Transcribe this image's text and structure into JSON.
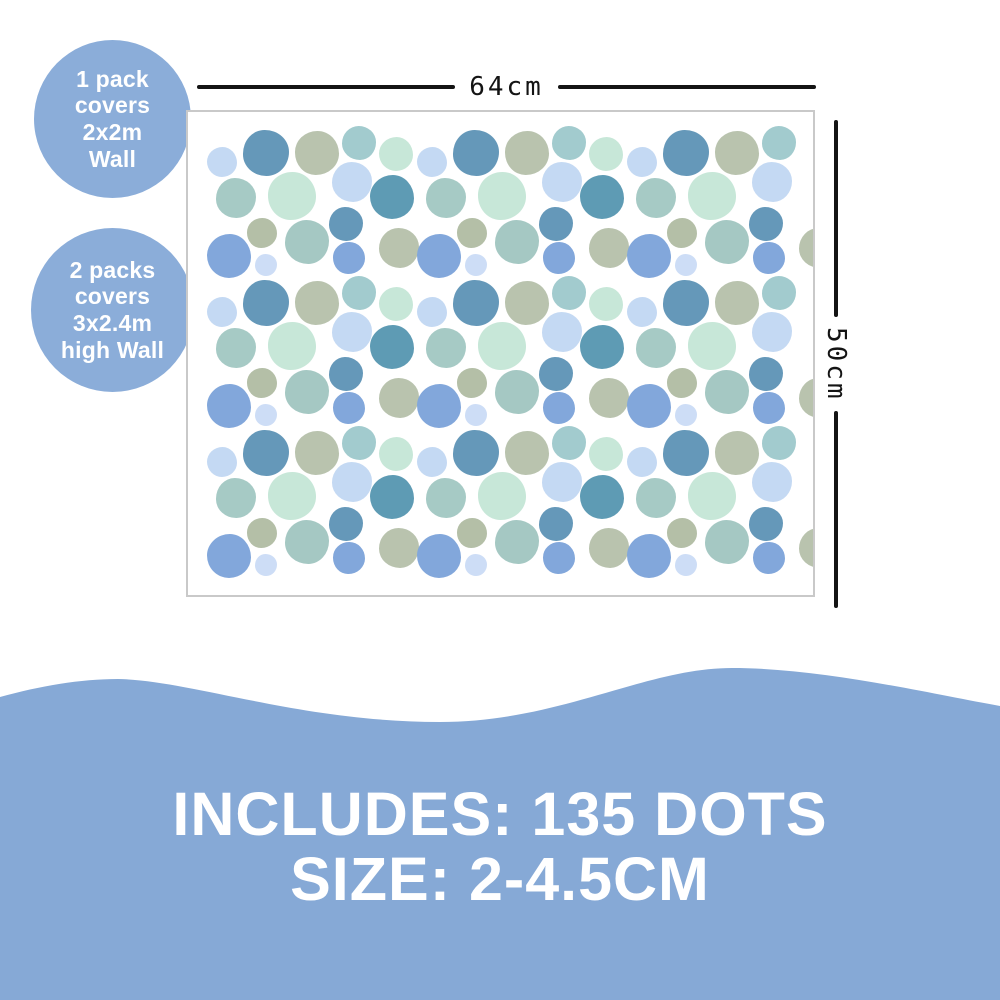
{
  "badges": [
    {
      "lines": [
        "1 pack",
        "covers",
        "2x2m",
        "Wall"
      ]
    },
    {
      "lines": [
        "2 packs",
        "covers",
        "3x2.4m",
        "high Wall"
      ]
    }
  ],
  "dimensions": {
    "width_label": "64cm",
    "height_label": "50cm"
  },
  "banner": {
    "line1": "INCLUDES: 135 DOTS",
    "line2": "SIZE: 2-4.5CM"
  },
  "colors": {
    "badge_blue": "#8badd9",
    "banner_blue": "#86a9d6",
    "dimension_line": "#141414",
    "sheet_border": "#c9c9c9",
    "sheet_bg": "#ffffff",
    "text_white": "#ffffff",
    "dot_palette": {
      "periwinkle": "#c4d9f3",
      "palePeri": "#cdddf6",
      "steel": "#6598b9",
      "darkTeal": "#5e9bb4",
      "sage": "#b9c3ae",
      "sageSmall": "#b4bfa7",
      "tealLight": "#a2cbce",
      "tealGray": "#a6cac5",
      "tealGreen": "#a5c8c3",
      "mint": "#c7e7d8",
      "cornflower": "#82a7db"
    }
  },
  "dots_pattern": {
    "tile_width": 210,
    "tile_height": 150,
    "cols": 3,
    "rows": 3,
    "offset_x": 2,
    "offset_y": 8,
    "dots": [
      {
        "x": 32,
        "y": 42,
        "r": 15,
        "c": "periwinkle",
        "s": 0
      },
      {
        "x": 76,
        "y": 33,
        "r": 23,
        "c": "steel",
        "s": 1
      },
      {
        "x": 127,
        "y": 33,
        "r": 22,
        "c": "sage",
        "s": 2
      },
      {
        "x": 169,
        "y": 23,
        "r": 17,
        "c": "tealLight",
        "s": 3
      },
      {
        "x": 206,
        "y": 34,
        "r": 17,
        "c": "mint",
        "s": 0,
        "skip_last_col": true
      },
      {
        "x": 46,
        "y": 78,
        "r": 20,
        "c": "tealGray",
        "s": 1
      },
      {
        "x": 102,
        "y": 76,
        "r": 24,
        "c": "mint",
        "s": 2
      },
      {
        "x": 162,
        "y": 62,
        "r": 20,
        "c": "periwinkle",
        "s": 3
      },
      {
        "x": 202,
        "y": 77,
        "r": 22,
        "c": "darkTeal",
        "s": 0,
        "skip_last_col": true
      },
      {
        "x": 156,
        "y": 104,
        "r": 17,
        "c": "steel",
        "s": 1
      },
      {
        "x": 72,
        "y": 113,
        "r": 15,
        "c": "sageSmall",
        "s": 2
      },
      {
        "x": 117,
        "y": 122,
        "r": 22,
        "c": "tealGreen",
        "s": 3
      },
      {
        "x": 39,
        "y": 136,
        "r": 22,
        "c": "cornflower",
        "s": 0
      },
      {
        "x": 76,
        "y": 145,
        "r": 11,
        "c": "palePeri",
        "s": 1
      },
      {
        "x": 159,
        "y": 138,
        "r": 16,
        "c": "cornflower",
        "s": 2
      },
      {
        "x": 209,
        "y": 128,
        "r": 20,
        "c": "sage",
        "s": 3
      }
    ]
  }
}
